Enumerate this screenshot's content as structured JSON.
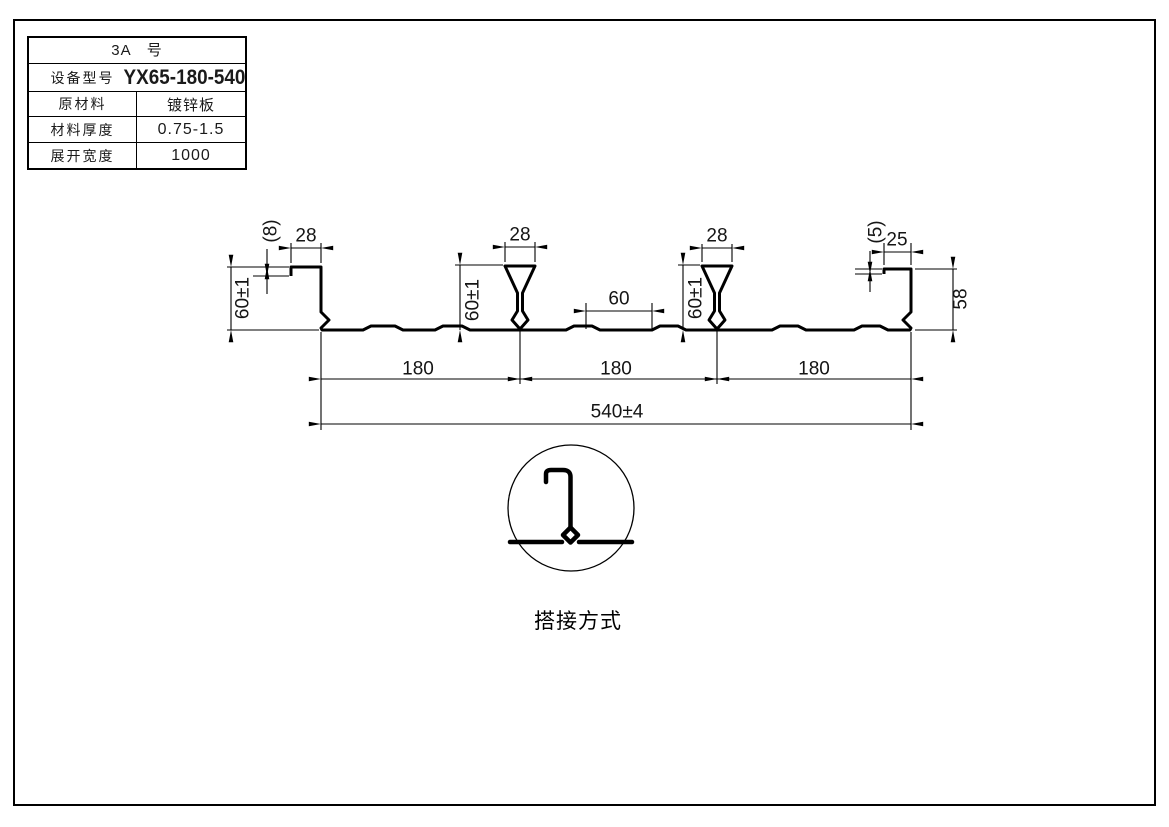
{
  "spec_table": {
    "title": "3A　号",
    "rows": [
      {
        "label": "设备型号",
        "value": "YX65-180-540"
      },
      {
        "label": "原材料",
        "value": "镀锌板"
      },
      {
        "label": "材料厚度",
        "value": "0.75-1.5"
      },
      {
        "label": "展开宽度",
        "value": "1000"
      }
    ]
  },
  "dimensions": {
    "left_lip": "(8)",
    "left_top": "28",
    "left_height": "60±1",
    "rib1_top": "28",
    "rib1_height": "60±1",
    "valley_flat": "60",
    "rib2_top": "28",
    "rib2_height": "60±1",
    "right_lip": "(5)",
    "right_top": "25",
    "right_height": "58",
    "pitch_1": "180",
    "pitch_2": "180",
    "pitch_3": "180",
    "overall_width": "540±4"
  },
  "detail": {
    "caption": "搭接方式"
  },
  "colors": {
    "line": "#000000",
    "background": "#ffffff"
  }
}
